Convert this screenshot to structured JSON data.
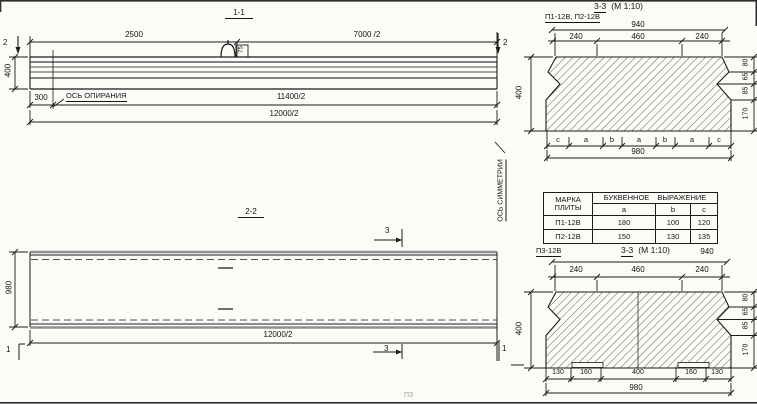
{
  "s11": {
    "title": "1-1",
    "dim_2500": "2500",
    "dim_7000": "7000 /2",
    "marker_2": "2",
    "dim_400": "400",
    "dim_300": "300",
    "axis_label": "ОСЬ ОПИРАНИЯ",
    "dim_11400": "11400/2",
    "dim_12000": "12000/2",
    "loop_tag": "75"
  },
  "s22": {
    "title": "2-2",
    "marker_3": "3",
    "marker_1": "1",
    "dim_980": "980",
    "dim_12000": "12000/2",
    "symmetry_label": "ОСЬ СИММЕТРИИ"
  },
  "s33a": {
    "label": "П1-12В, П2-12В",
    "title_num": "3-3",
    "title_scale": "(М 1:10)",
    "dim_940": "940",
    "dims_top": [
      "240",
      "460",
      "240"
    ],
    "dim_400": "400",
    "dims_right": [
      "80",
      "65",
      "85",
      "170"
    ],
    "letters": [
      "c",
      "a",
      "b",
      "a",
      "b",
      "a",
      "c"
    ],
    "dim_980": "980"
  },
  "table": {
    "head_mark_1": "МАРКА",
    "head_mark_2": "ПЛИТЫ",
    "head_expr": "БУКВЕННОЕ  ВЫРАЖЕНИЕ",
    "cols": [
      "a",
      "b",
      "c"
    ],
    "rows": [
      [
        "П1-12В",
        "180",
        "100",
        "120"
      ],
      [
        "П2-12В",
        "150",
        "130",
        "135"
      ]
    ]
  },
  "s33b": {
    "label": "П3-12В",
    "title_num": "3-3",
    "title_scale": "(М 1:10)",
    "dim_940": "940",
    "dims_top": [
      "240",
      "460",
      "240"
    ],
    "dim_400": "400",
    "dims_right": [
      "80",
      "65",
      "85",
      "170"
    ],
    "dims_bottom": [
      "130",
      "160",
      "400",
      "160",
      "130"
    ],
    "dim_980": "980"
  },
  "artifact": "ПЗ"
}
